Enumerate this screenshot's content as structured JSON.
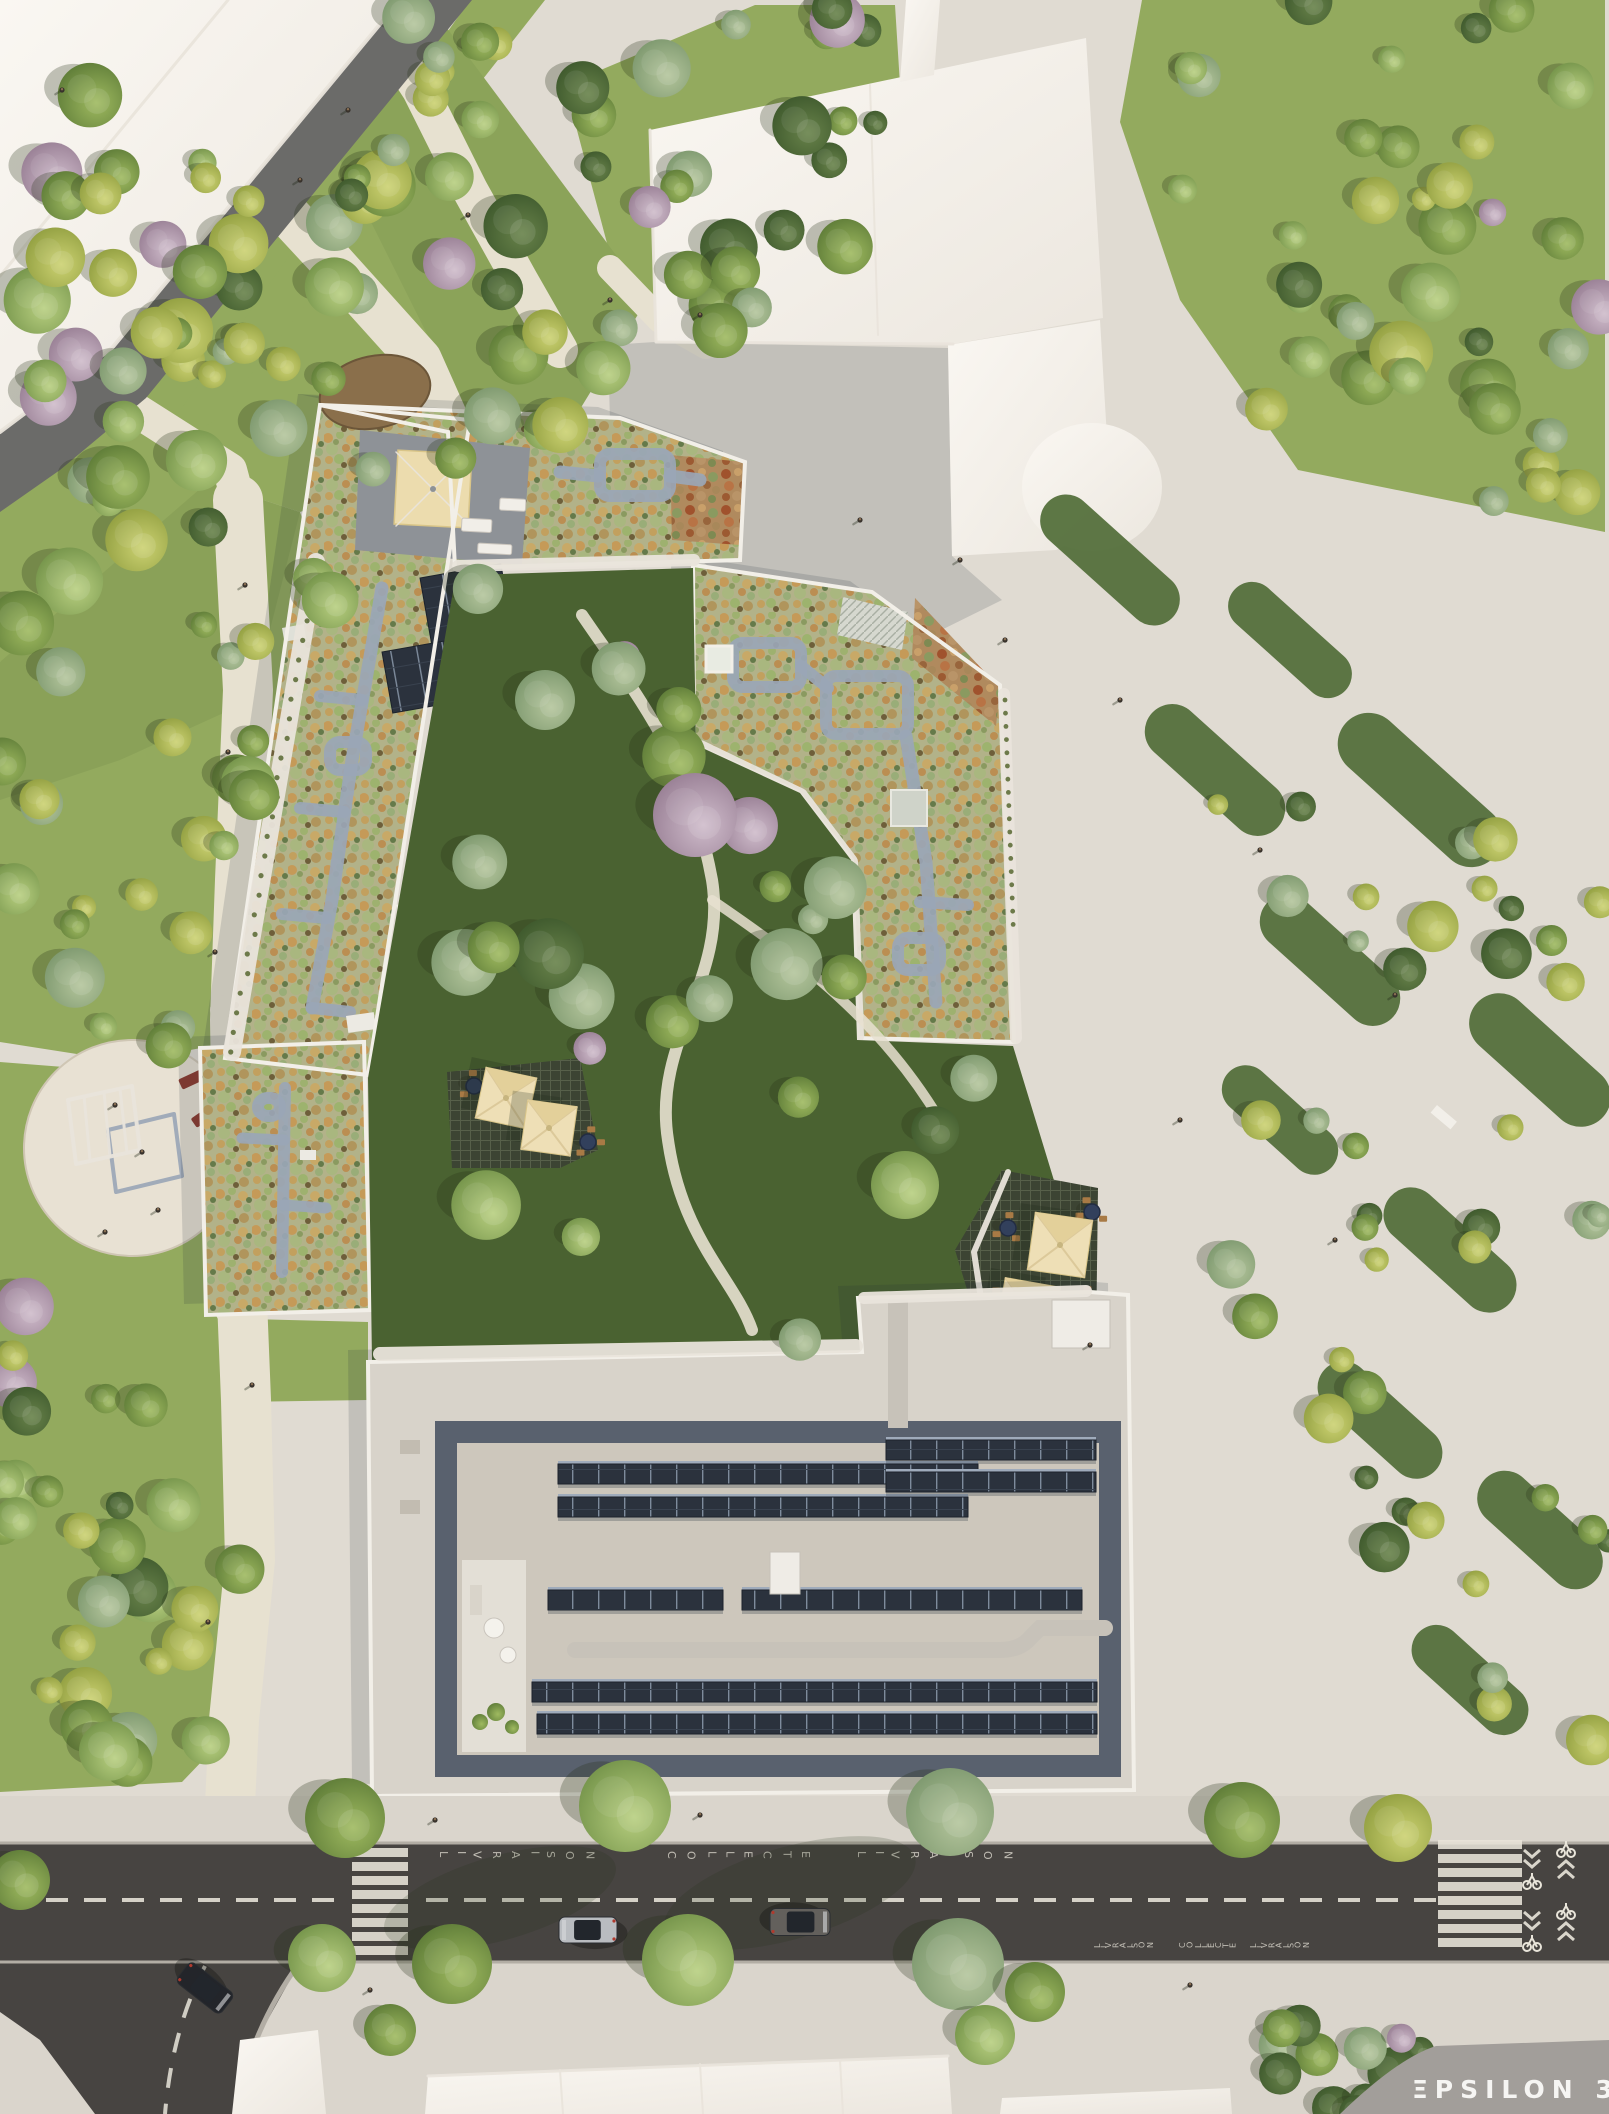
{
  "title": "Aerial architectural rendering of a residential block with green sedum roofs, central garden courtyard, park, and street",
  "watermark": {
    "text": "ΞPSILON 3D"
  },
  "road_markings": {
    "top_lane": [
      "LIVRAISON",
      "COLLECTE",
      "LIVRAISON"
    ],
    "bottom_lane": [
      "LIVRAISON",
      "COLLECTE",
      "LIVRAISON"
    ]
  },
  "scene": {
    "buildings": [
      "white office building north-east",
      "white buildings north-west",
      "green-roof west wing",
      "green-roof east wing",
      "green-roof south-west wing",
      "south building with solar panels",
      "white buildings south edge"
    ],
    "features": [
      "central courtyard garden",
      "public park with playground",
      "rooftop terrace with pergola",
      "courtyard terraces with parasols",
      "street with crosswalks and bike markings",
      "pond"
    ],
    "cars": 3,
    "parasols": 4,
    "crosswalks": 2
  },
  "palette": {
    "plaza": "#e0dbd2",
    "sidewalk": "#dad5cc",
    "curb": "#b2ada4",
    "asphalt": "#474441",
    "marking": "#e9e5da",
    "grass_park": "#93aa5e",
    "grass_park_dark": "#7c9450",
    "grass_dark": "#4a6231",
    "path": "#e7e1d0",
    "building_white": "#f7f3ed",
    "shadow_color": "#1d2733",
    "sedum_base": "#b2b289",
    "roof_walk": "#9aa6b6",
    "parapet": "#f2efe8",
    "deck": "#8e9297",
    "pergola": "#ecdcae",
    "roof_light": "#d8d3ca",
    "roof_inner": "#cdc7bc",
    "roof_band": "#59616e",
    "solar": "#2b323d",
    "duct": "#c7c2b9",
    "balcony": "#e9e4db",
    "water": "#8a6f4b",
    "bench_red": "#8e3d31",
    "table_navy": "#32405c",
    "wood": "#a87a45",
    "watermark_band": "#a29e9a",
    "hedge": "#54703c",
    "tree_shadow": "#243018",
    "road_nw": "#6b6b69"
  }
}
